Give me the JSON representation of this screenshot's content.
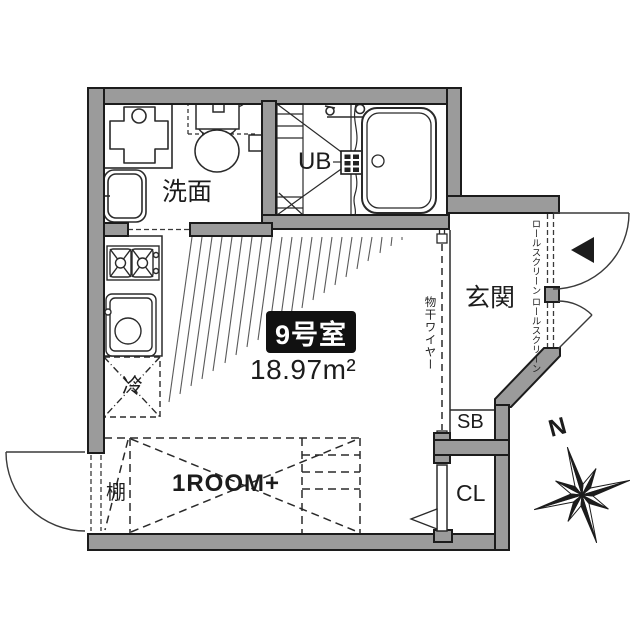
{
  "unit": {
    "room_label": "9号室",
    "area_value": "18.97",
    "area_unit": "m²",
    "layout_type": "1ROOM+"
  },
  "rooms": {
    "washroom": "洗面",
    "unit_bath": "UB",
    "entrance": "玄関",
    "shoe_box": "SB",
    "closet": "CL"
  },
  "fixtures": {
    "refrigerator": "冷",
    "shelf": "棚",
    "laundry_wire": "物干ワイヤー",
    "roll_screen_upper": "ロールスクリーン",
    "roll_screen_lower": "ロールスクリーン"
  },
  "compass": {
    "north_label": "N"
  },
  "colors": {
    "wall_fill": "#9b9b9b",
    "outline": "#1c1c1c",
    "badge_bg": "#111111",
    "badge_text": "#ffffff"
  }
}
